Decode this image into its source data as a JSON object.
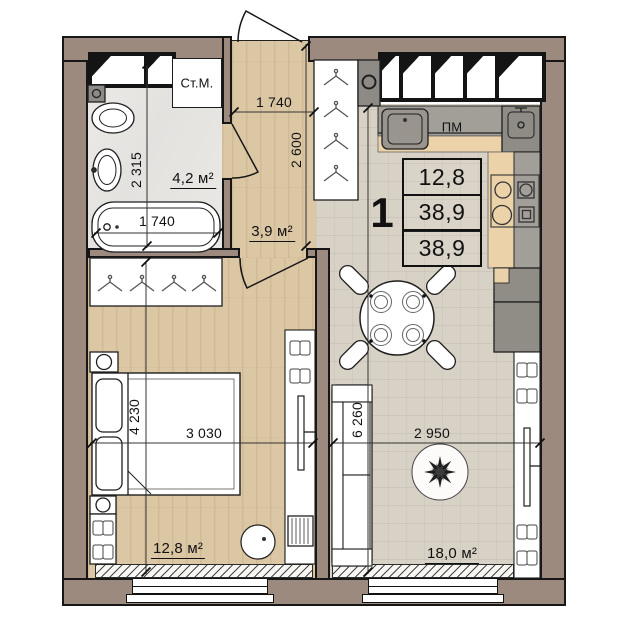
{
  "info_table": {
    "rooms_count": "1",
    "living_area": "12,8",
    "area_mid": "38,9",
    "total_area": "38,9"
  },
  "areas": {
    "bathroom": "4,2 м²",
    "hallway": "3,9 м²",
    "bedroom": "12,8 м²",
    "living_kitchen": "18,0 м²"
  },
  "appliances": {
    "washing_machine": "Ст.М.",
    "dishwasher": "ПМ"
  },
  "dimensions": {
    "bathroom_depth": "2 315",
    "bathtub_length": "1 740",
    "hallway_width": "1 740",
    "hallway_depth": "2 600",
    "bedroom_depth": "4 230",
    "bedroom_width": "3 030",
    "living_depth": "6 260",
    "living_width": "2 950"
  },
  "colors": {
    "wall": "#9c8a7e",
    "wood_floor": "#dcc7a5",
    "tile_floor": "#d8d1c5",
    "bath_floor": "#e8e7e4",
    "counter_gray": "#a29f99",
    "counter_wood": "#ecd2a9",
    "line": "#1a1a1a"
  }
}
